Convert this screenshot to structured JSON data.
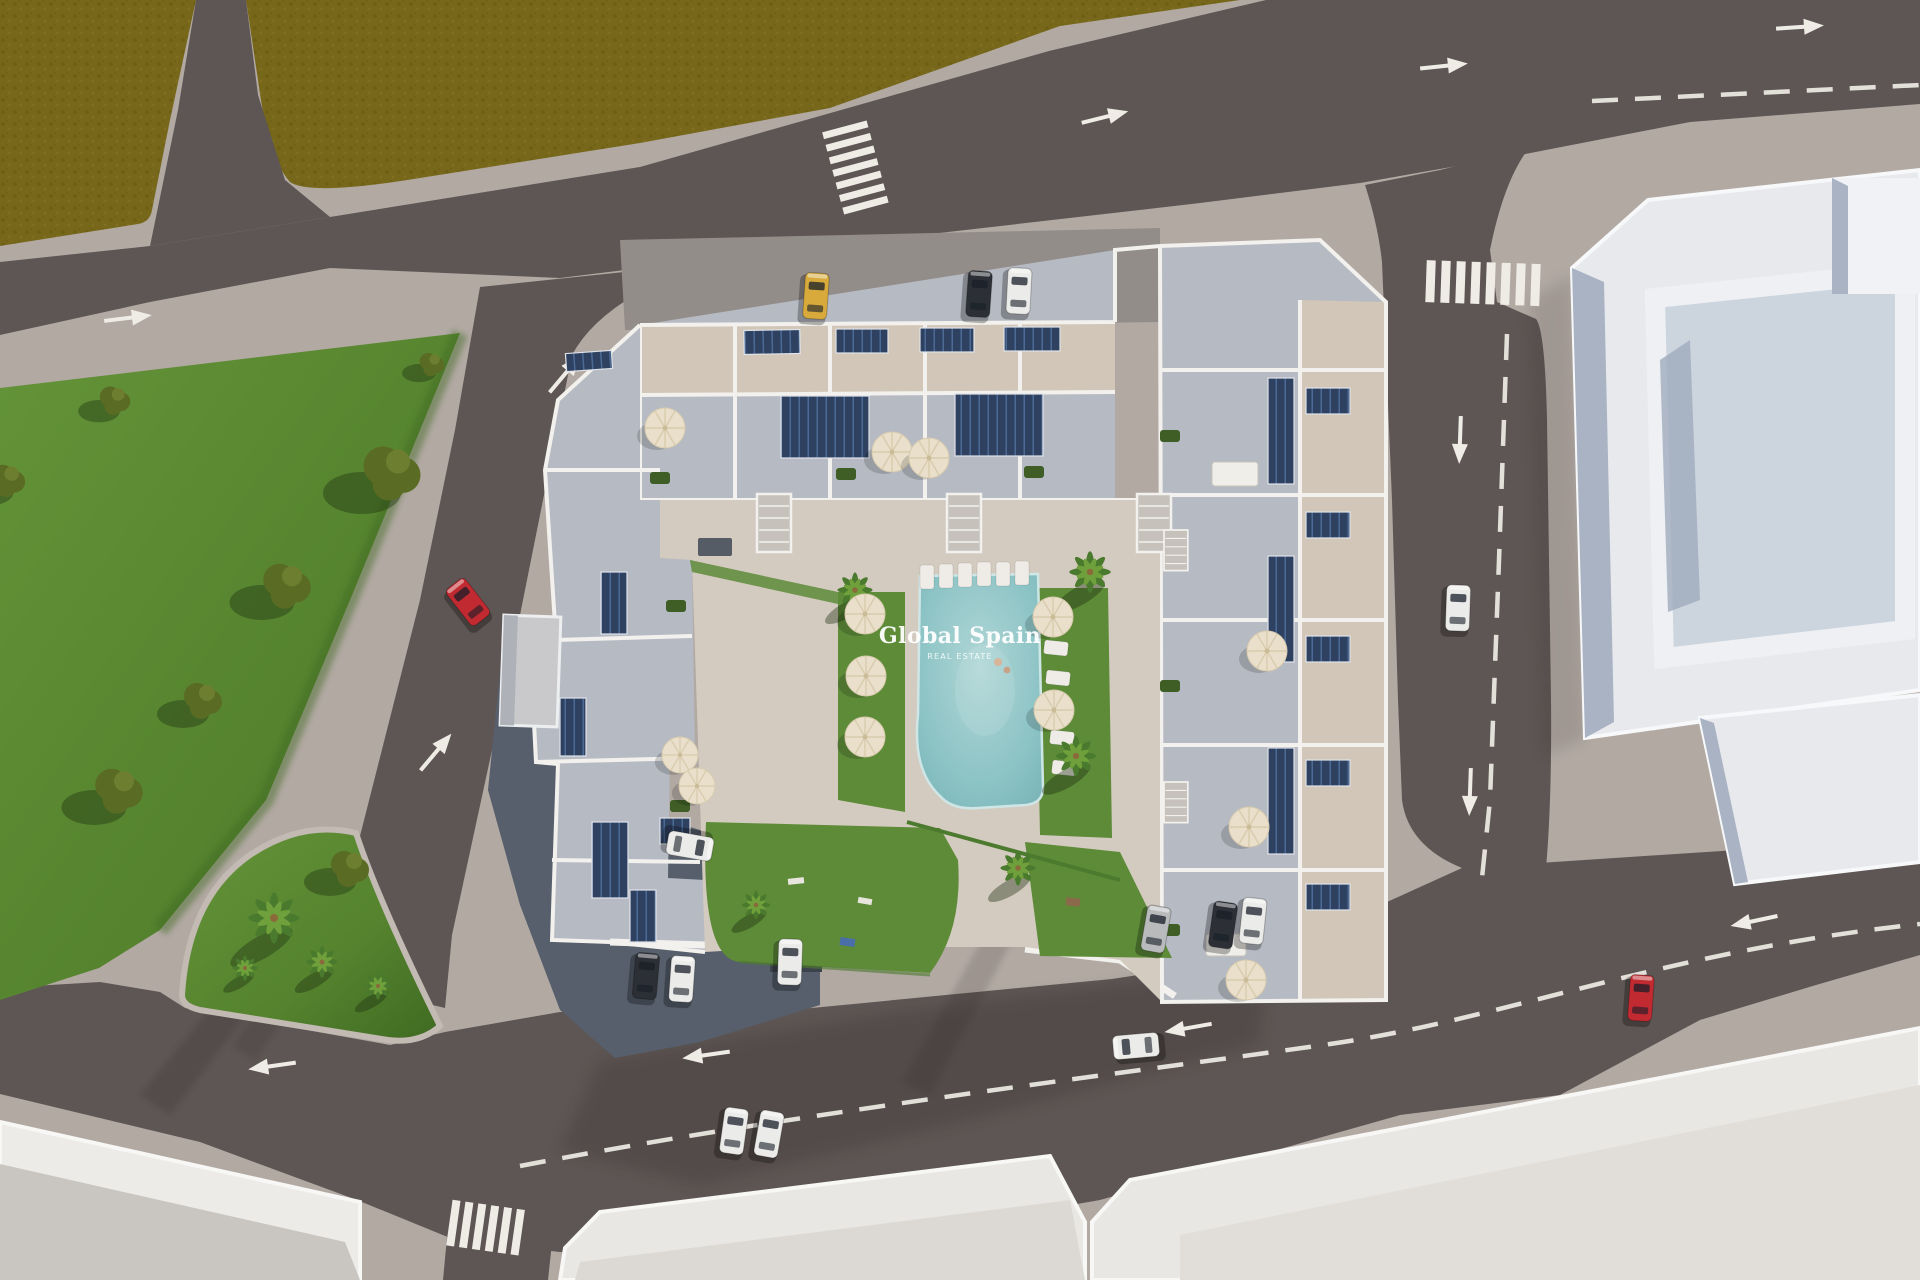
{
  "image": {
    "type": "aerial-3d-architectural-render",
    "description": "Bird's-eye 3D render of a new-build residential complex with rooftop terraces, solar panels and a central pool courtyard, surrounded by streets, a public park, an olive field and neighbouring white buildings",
    "width": 1920,
    "height": 1280
  },
  "watermark": {
    "title": "Global Spain",
    "subtitle": "REAL ESTATE"
  },
  "colors": {
    "sidewalk": "#b2a9a3",
    "road": "#5e5654",
    "parking_strip": "#938d89",
    "field": "#77671a",
    "field_dark": "#685a10",
    "field_light": "#857424",
    "park": "#55832e",
    "park_light": "#649339",
    "park_dark": "#3f6a22",
    "lawn": "#5d8b38",
    "tree": "#5a6b24",
    "palm": "#4a7a2d",
    "pool": "#8ac2c4",
    "pool_light": "#b0d6d6",
    "wall": "#f2f1ed",
    "terrace_cool": "#b6bac3",
    "terrace_warm": "#d1c6b7",
    "deck": "#d4cbc0",
    "solar": "#2e4160",
    "solar_light": "#4c6a96",
    "umbrella": "#e9dfca",
    "roof_white": "#e8e9ec",
    "roof_shade": "#c9c6c2",
    "building_side": "#a9b3c3",
    "building_court": "#ccd4de",
    "garage": "#565f6b",
    "aux_building": "#c9c9cc",
    "marking": "#efece6",
    "car_red": "#c22a31",
    "car_yellow": "#d8aa3c",
    "car_white": "#ebebe9",
    "car_dark": "#2c3036",
    "car_silver": "#b9babc"
  },
  "scene": {
    "road_markings": {
      "crosswalks": 3,
      "dashed_center_lines": 3,
      "direction_arrows": 12
    },
    "counts": {
      "cars": 16,
      "parasols": 13,
      "solar_panels": 20,
      "park_trees": 7,
      "palm_trees": 9
    },
    "cars": [
      {
        "color": "yellow",
        "state": "parked",
        "area": "north parking"
      },
      {
        "color": "dark",
        "state": "parked",
        "area": "north parking"
      },
      {
        "color": "white",
        "state": "parked",
        "area": "north parking"
      },
      {
        "color": "red",
        "state": "driving",
        "area": "west road"
      },
      {
        "color": "white",
        "state": "driving",
        "area": "east road"
      },
      {
        "color": "white",
        "state": "parked",
        "area": "west side"
      },
      {
        "color": "dark",
        "state": "parked",
        "area": "south-west corner"
      },
      {
        "color": "white",
        "state": "parked",
        "area": "south-west corner"
      },
      {
        "color": "white",
        "state": "parked",
        "area": "garage entrance"
      },
      {
        "color": "silver",
        "state": "parked",
        "area": "south-east parking"
      },
      {
        "color": "dark",
        "state": "parked",
        "area": "south-east parking"
      },
      {
        "color": "white",
        "state": "parked",
        "area": "south-east parking"
      },
      {
        "color": "white",
        "state": "driving",
        "area": "south road"
      },
      {
        "color": "white",
        "state": "driving",
        "area": "south road"
      },
      {
        "color": "white",
        "state": "driving",
        "area": "south road"
      },
      {
        "color": "red",
        "state": "driving",
        "area": "south-east road"
      }
    ],
    "features": [
      "U-shaped apartment complex with rooftop terraces",
      "central swimming pool with sun loungers",
      "courtyard lawns and playground",
      "rooftop solar panels",
      "cream parasols on terraces",
      "public park with olive trees",
      "green traffic island with palm trees",
      "olive field to the north-west",
      "large white neighbouring buildings"
    ]
  }
}
